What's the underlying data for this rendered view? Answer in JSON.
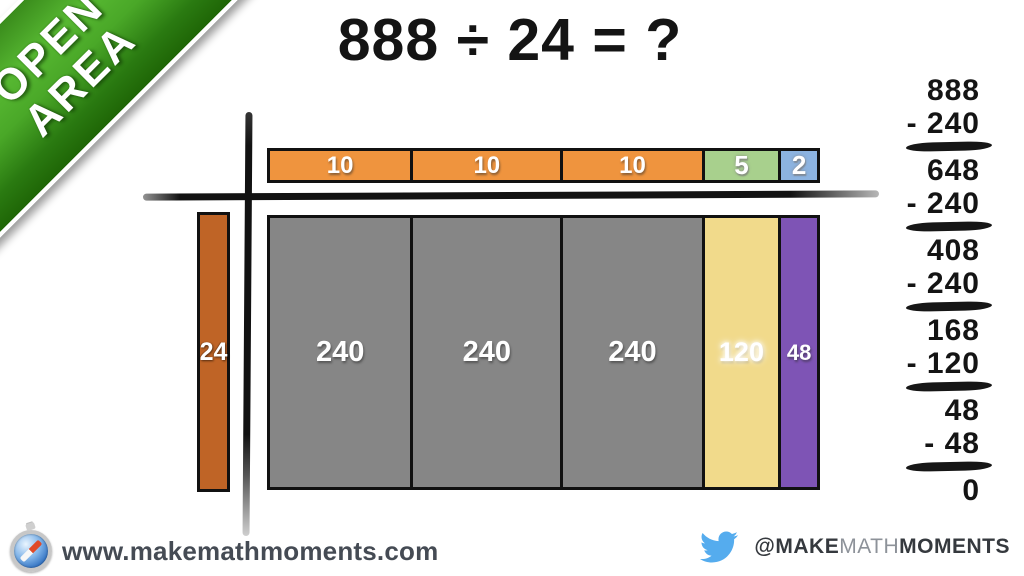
{
  "banner": {
    "line1": "OPEN",
    "line2": "AREA"
  },
  "title": {
    "text": "888 ÷ 24 = ?"
  },
  "area_model": {
    "divisor_label": "24",
    "quotient_segments": [
      {
        "label": "10"
      },
      {
        "label": "10"
      },
      {
        "label": "10"
      },
      {
        "label": "5"
      },
      {
        "label": "2"
      }
    ],
    "product_segments": [
      {
        "label": "240"
      },
      {
        "label": "240"
      },
      {
        "label": "240"
      },
      {
        "label": "120"
      },
      {
        "label": "48"
      }
    ]
  },
  "subtraction": {
    "rows": [
      {
        "text": "888"
      },
      {
        "text": "- 240"
      },
      {
        "text": "648"
      },
      {
        "text": "- 240"
      },
      {
        "text": "408"
      },
      {
        "text": "- 240"
      },
      {
        "text": "168"
      },
      {
        "text": "- 120"
      },
      {
        "text": "48"
      },
      {
        "text": "- 48"
      },
      {
        "text": "0"
      }
    ]
  },
  "footer": {
    "website": "www.makemathmoments.com",
    "twitter_handle": {
      "prefix": "@MAKE",
      "middle": "MATH",
      "suffix": "MOMENTS"
    }
  },
  "colors": {
    "banner_green_light": "#57b832",
    "banner_green_dark": "#1f6606",
    "quotient_tens_orange": "#ef943e",
    "quotient_five_green": "#a8d08d",
    "quotient_two_blue": "#8cb3e0",
    "divisor_rust": "#bf6426",
    "product_gray": "#868686",
    "product_yellow": "#f1da8b",
    "product_purple": "#7e54b5",
    "twitter_blue": "#55acee",
    "ink_black": "#141414",
    "footer_text_gray": "#454b54"
  }
}
